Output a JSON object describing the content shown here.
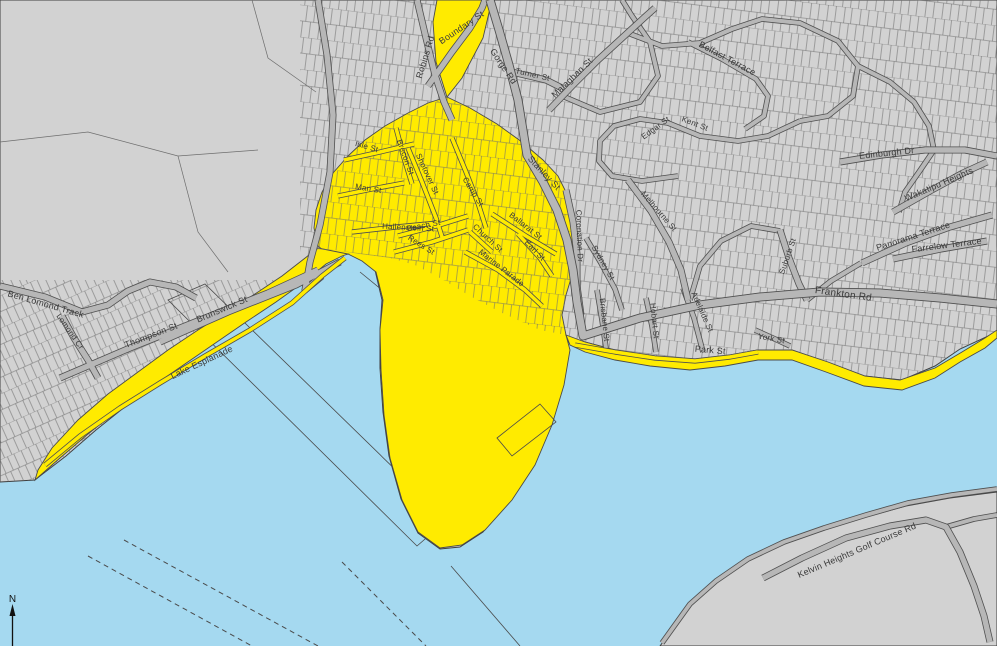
{
  "map": {
    "colors": {
      "water": "#a5d9f0",
      "land": "#d2d2d2",
      "outline": "#3f3f3f",
      "road_fill": "#b7b7b7",
      "road_casing": "#4f4f4f",
      "zone": "#ffeb00",
      "zone_outline": "#4a4a4a",
      "parcel_line": "#6e6e6e",
      "survey_line": "#4a4a4a",
      "label_color": "#3a3a3a",
      "north": "#111111"
    },
    "north_arrow_label": "N",
    "street_labels": [
      {
        "t": "Ben Lomond Track",
        "x": 45,
        "y": 307,
        "r": 16,
        "s": 9
      },
      {
        "t": "Lomond Cr",
        "x": 68,
        "y": 333,
        "r": 55,
        "s": 8
      },
      {
        "t": "Thompson St",
        "x": 152,
        "y": 338,
        "r": -21,
        "s": 9
      },
      {
        "t": "Brunswick St",
        "x": 223,
        "y": 312,
        "r": -23,
        "s": 9
      },
      {
        "t": "Lake Esplanade",
        "x": 203,
        "y": 365,
        "r": -25,
        "s": 9
      },
      {
        "t": "Robins Rd",
        "x": 428,
        "y": 58,
        "r": -73,
        "s": 9
      },
      {
        "t": "Boundary St",
        "x": 463,
        "y": 30,
        "r": -34,
        "s": 9
      },
      {
        "t": "Gorge Rd",
        "x": 501,
        "y": 68,
        "r": 56,
        "s": 9
      },
      {
        "t": "Turner St",
        "x": 532,
        "y": 77,
        "r": 13,
        "s": 8
      },
      {
        "t": "Malaghan St",
        "x": 574,
        "y": 80,
        "r": -44,
        "s": 9
      },
      {
        "t": "Belfast Terrace",
        "x": 726,
        "y": 61,
        "r": 28,
        "s": 9
      },
      {
        "t": "Edgar St",
        "x": 657,
        "y": 130,
        "r": -36,
        "s": 8
      },
      {
        "t": "Kent St",
        "x": 694,
        "y": 126,
        "r": 21,
        "s": 8
      },
      {
        "t": "Edinburgh Dr",
        "x": 887,
        "y": 156,
        "r": -6,
        "s": 9
      },
      {
        "t": "Wakatipu Heights",
        "x": 940,
        "y": 187,
        "r": -23,
        "s": 9
      },
      {
        "t": "Panorama Terrace",
        "x": 914,
        "y": 239,
        "r": -18,
        "s": 9
      },
      {
        "t": "Farrelow Terrace",
        "x": 947,
        "y": 248,
        "r": -7,
        "s": 9
      },
      {
        "t": "Frankton Rd",
        "x": 843,
        "y": 297,
        "r": 8,
        "s": 10
      },
      {
        "t": "Suburb St",
        "x": 790,
        "y": 257,
        "r": -71,
        "s": 8
      },
      {
        "t": "Melbourne St",
        "x": 657,
        "y": 213,
        "r": 49,
        "s": 8
      },
      {
        "t": "Sydney St",
        "x": 601,
        "y": 264,
        "r": 60,
        "s": 8
      },
      {
        "t": "Coronation Dr",
        "x": 577,
        "y": 236,
        "r": 88,
        "s": 8
      },
      {
        "t": "Stanley St",
        "x": 542,
        "y": 175,
        "r": 47,
        "s": 9
      },
      {
        "t": "Shotover St",
        "x": 425,
        "y": 175,
        "r": 65,
        "s": 8
      },
      {
        "t": "Camp St",
        "x": 471,
        "y": 193,
        "r": 58,
        "s": 8
      },
      {
        "t": "Ballarat St",
        "x": 524,
        "y": 228,
        "r": 38,
        "s": 8
      },
      {
        "t": "Beach St",
        "x": 424,
        "y": 228,
        "r": -11,
        "s": 8
      },
      {
        "t": "Rees St",
        "x": 420,
        "y": 247,
        "r": 32,
        "s": 8
      },
      {
        "t": "Church St",
        "x": 486,
        "y": 240,
        "r": 43,
        "s": 8
      },
      {
        "t": "Earl St",
        "x": 533,
        "y": 252,
        "r": 46,
        "s": 8
      },
      {
        "t": "Marine Parade",
        "x": 500,
        "y": 270,
        "r": 38,
        "s": 8
      },
      {
        "t": "Man St",
        "x": 368,
        "y": 191,
        "r": 9,
        "s": 8
      },
      {
        "t": "Isle St",
        "x": 366,
        "y": 149,
        "r": 16,
        "s": 8
      },
      {
        "t": "Brecon St",
        "x": 403,
        "y": 158,
        "r": 70,
        "s": 8
      },
      {
        "t": "Hallenstein St",
        "x": 408,
        "y": 230,
        "r": 3,
        "s": 8
      },
      {
        "t": "Park St",
        "x": 710,
        "y": 353,
        "r": 5,
        "s": 9
      },
      {
        "t": "Adelaide St",
        "x": 700,
        "y": 313,
        "r": 66,
        "s": 8
      },
      {
        "t": "Hobart St",
        "x": 652,
        "y": 321,
        "r": 84,
        "s": 8
      },
      {
        "t": "Brisbane St",
        "x": 602,
        "y": 320,
        "r": 84,
        "s": 8
      },
      {
        "t": "York St",
        "x": 771,
        "y": 341,
        "r": 10,
        "s": 8
      },
      {
        "t": "Kelvin Heights Golf Course Rd",
        "x": 858,
        "y": 553,
        "r": -23,
        "s": 9
      }
    ]
  }
}
